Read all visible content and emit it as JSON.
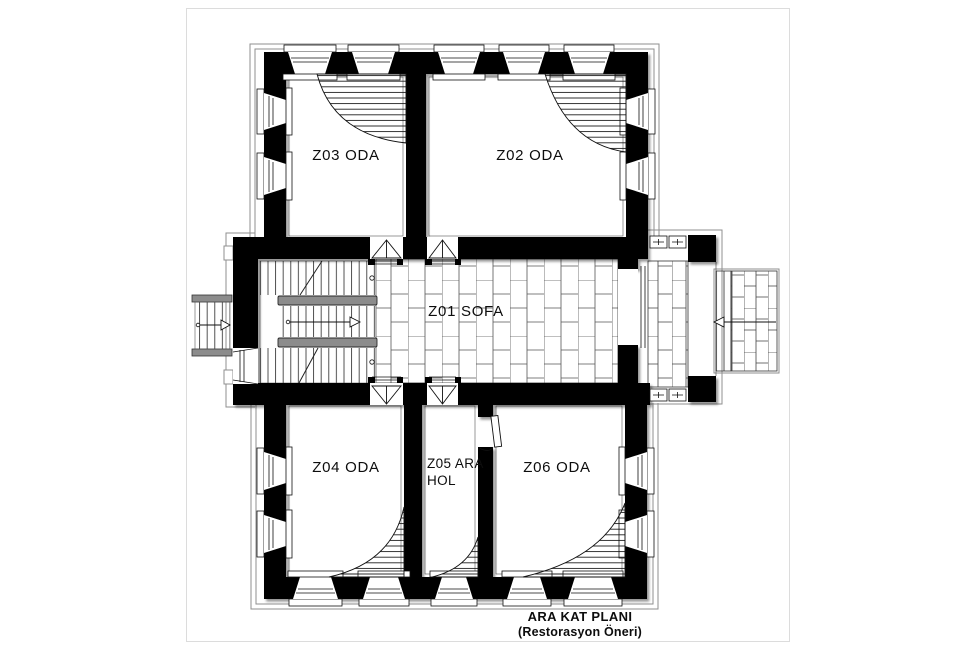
{
  "drawing": {
    "caption": {
      "title": "ARA KAT PLANI",
      "subtitle": "(Restorasyon Öneri)"
    },
    "rooms": {
      "z01": "Z01 SOFA",
      "z02": "Z02 ODA",
      "z03": "Z03 ODA",
      "z04": "Z04 ODA",
      "z05_line1": "Z05 ARA",
      "z05_line2": "HOL",
      "z06": "Z06 ODA"
    },
    "colors": {
      "paper": "#ffffff",
      "wall": "#000000",
      "ink": "#111111",
      "outline": "#8f8f8f",
      "rail": "#8c8c8c"
    }
  }
}
